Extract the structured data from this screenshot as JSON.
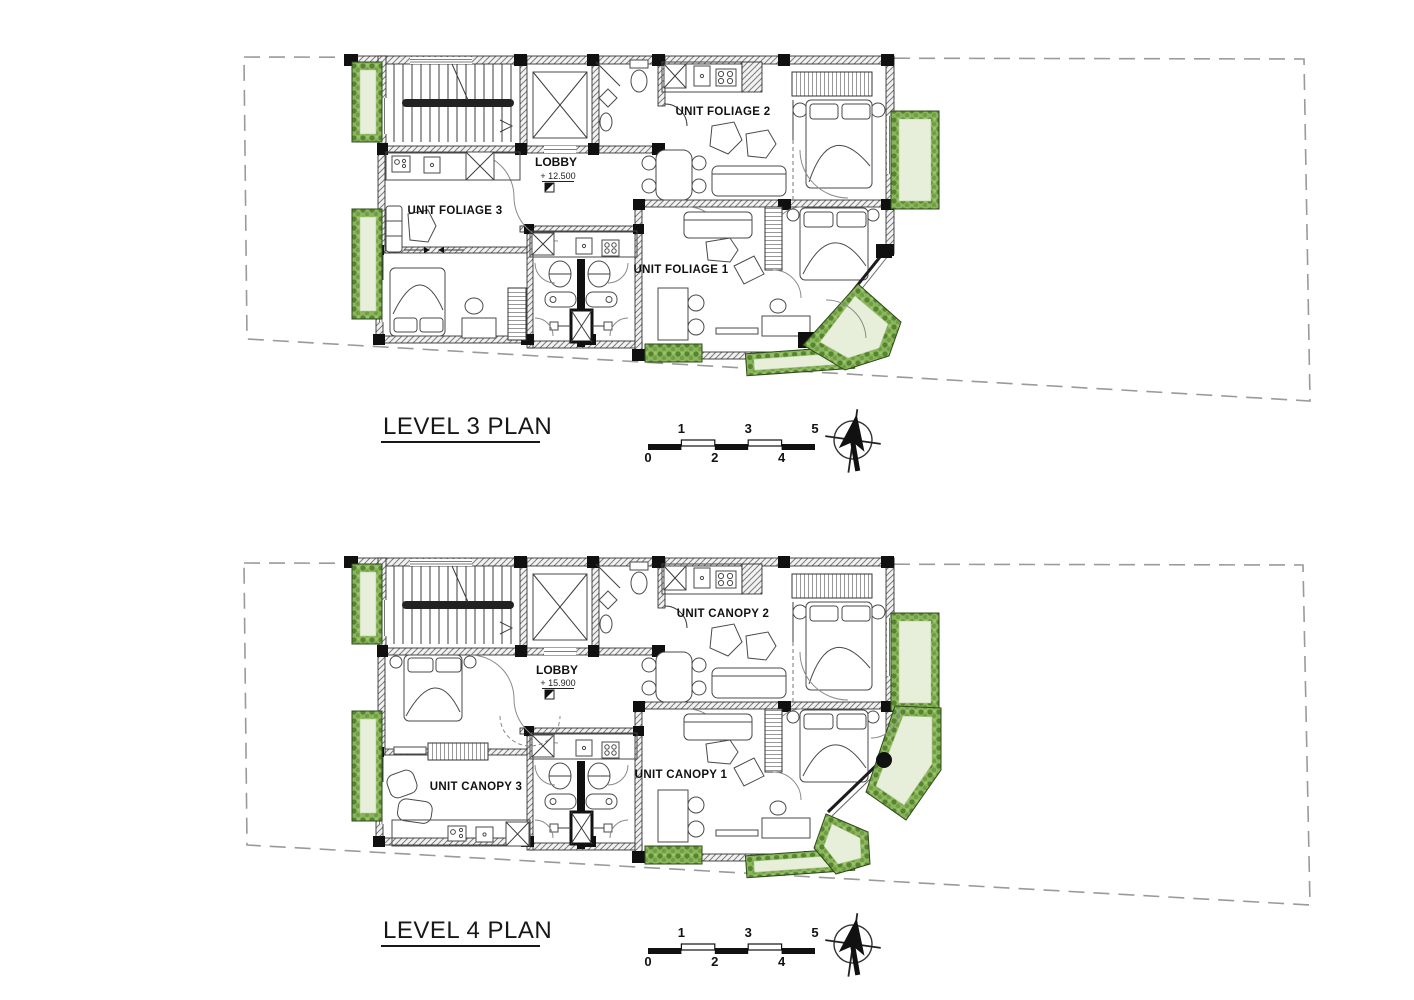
{
  "sheet": {
    "background": "#ffffff"
  },
  "plans": [
    {
      "title": "LEVEL 3 PLAN",
      "lobby": {
        "label": "LOBBY",
        "elevation": "+ 12.500"
      },
      "units": [
        {
          "label": "UNIT FOLIAGE 2"
        },
        {
          "label": "UNIT FOLIAGE 3"
        },
        {
          "label": "UNIT FOLIAGE 1"
        }
      ]
    },
    {
      "title": "LEVEL 4 PLAN",
      "lobby": {
        "label": "LOBBY",
        "elevation": "+ 15.900"
      },
      "units": [
        {
          "label": "UNIT CANOPY 2"
        },
        {
          "label": "UNIT CANOPY 3"
        },
        {
          "label": "UNIT CANOPY 1"
        }
      ]
    }
  ],
  "scale_bar": {
    "ticks_top": [
      "1",
      "3",
      "5"
    ],
    "ticks_bottom": [
      "0",
      "2",
      "4"
    ]
  },
  "north_arrow": {
    "icon": "north-arrow-icon"
  },
  "colors": {
    "wall_hatch": "#7d7d7d",
    "column": "#101010",
    "planter_border_green": "#6f9e43",
    "planter_fill_green": "#e7efda",
    "boundary_dash": "#9a9a9a",
    "ink": "#171717"
  }
}
